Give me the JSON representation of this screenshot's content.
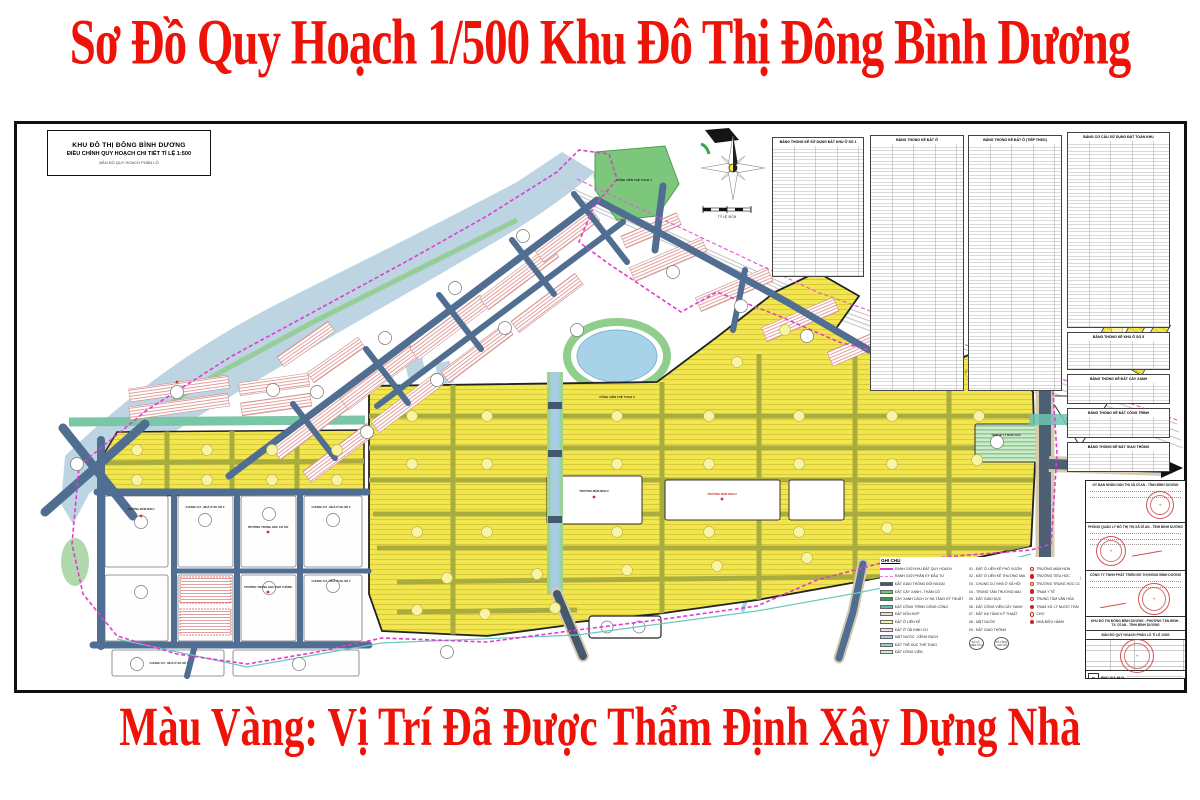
{
  "header": {
    "title": "Sơ Đồ Quy Hoạch 1/500 Khu Đô Thị Đông Bình Dương"
  },
  "footer": {
    "note": "Màu Vàng: Vị Trí Đã Được Thẩm Định Xây Dựng Nhà"
  },
  "title_block": {
    "line1": "KHU ĐÔ THỊ ĐÔNG BÌNH DƯƠNG",
    "line2": "ĐIỀU CHỈNH QUY HOẠCH CHI TIẾT TỈ LỆ 1:500",
    "line3": "BẢN ĐỒ QUY HOẠCH PHÂN LÔ"
  },
  "compass": {
    "scale_label": "TỶ LỆ XÍCH"
  },
  "stat_tables": [
    {
      "title": "BẢNG THỐNG KÊ SỬ DỤNG ĐẤT KHU Ở SỐ 1"
    },
    {
      "title": "BẢNG THỐNG KÊ ĐẤT Ở"
    },
    {
      "title": "BẢNG THỐNG KÊ ĐẤT Ở (TIẾP THEO)"
    },
    {
      "title": "BẢNG CƠ CẤU SỬ DỤNG ĐẤT TOÀN KHU"
    },
    {
      "title": "BẢNG THỐNG KÊ KHU Ở SỐ 5"
    },
    {
      "title": "BẢNG THỐNG KÊ ĐẤT CÂY XANH"
    },
    {
      "title": "BẢNG THỐNG KÊ ĐẤT CÔNG TRÌNH"
    },
    {
      "title": "BẢNG THỐNG KÊ ĐẤT GIAO THÔNG"
    }
  ],
  "map_labels": {
    "park1": "CÔNG VIÊN THỂ THAO 1",
    "park2": "CÔNG VIÊN THỂ THAO 2",
    "mn1": "TRƯỜNG MẦM NON 1",
    "mn2": "TRƯỜNG MẦM NON 2",
    "mn3": "TRƯỜNG MẦM NON 3",
    "mn4": "TRƯỜNG MẦM NON 4",
    "wwtp": "TRẠM XỬ LÝ NƯỚC THẢI",
    "apt1": "CHUNG CƯ - NHÀ Ở XH SỐ 1",
    "apt2": "CHUNG CƯ - NHÀ Ở XH SỐ 2",
    "apt3": "CHUNG CƯ - NHÀ Ở XH SỐ 3",
    "apt4": "CHUNG CƯ - NHÀ Ở XH SỐ 4",
    "thcs": "TRƯỜNG TRUNG HỌC CƠ SỞ",
    "thpt": "TRƯỜNG TRUNG HỌC PHỔ THÔNG"
  },
  "legend": {
    "title": "GHI CHÚ",
    "items": [
      {
        "swatch": "line-magenta",
        "label": "RANH GIỚI KHU ĐẤT QUY HOẠCH"
      },
      {
        "swatch": "line-pink-dash",
        "label": "RANH GIỚI PHÂN KỲ ĐẦU TƯ"
      },
      {
        "swatch": "#3c5a78",
        "label": "ĐẤT GIAO THÔNG ĐỐI NGOẠI"
      },
      {
        "swatch": "#6cc96c",
        "label": "ĐẤT CÂY XANH - THẢM CỎ"
      },
      {
        "swatch": "#2f9e44",
        "label": "CÂY XANH CÁCH LY HẠ TẦNG KỸ THUẬT"
      },
      {
        "swatch": "#5fbfae",
        "label": "ĐẤT CÔNG TRÌNH CÔNG CỘNG"
      },
      {
        "swatch": "#e8ddc6",
        "label": "ĐẤT HỖN HỢP"
      },
      {
        "swatch": "#f4eeb0",
        "label": "ĐẤT Ở LIÊN KẾ"
      },
      {
        "swatch": "#f3dcdc",
        "label": "ĐẤT Ở TÁI ĐỊNH CƯ"
      },
      {
        "swatch": "#aacfe4",
        "label": "MẶT NƯỚC - KÊNH RẠCH"
      },
      {
        "swatch": "#8fd4c8",
        "label": "ĐẤT THỂ DỤC THỂ THAO"
      },
      {
        "swatch": "#cdeccd",
        "label": "ĐẤT CÔNG VIÊN"
      }
    ],
    "notes": [
      "01 - ĐẤT Ở LIÊN KẾ PHỐ VƯỜN",
      "02 - ĐẤT Ở LIÊN KẾ THƯƠNG MẠI",
      "03 - CHUNG CƯ NHÀ Ở XÃ HỘI",
      "04 - TRUNG TÂM THƯƠNG MẠI",
      "05 - ĐẤT GIÁO DỤC",
      "06 - ĐẤT CÔNG VIÊN CÂY XANH",
      "07 - ĐẤT HẠ TẦNG KỸ THUẬT",
      "08 - MẶT NƯỚC",
      "09 - ĐẤT GIAO THÔNG"
    ],
    "note_symbols": [
      {
        "label": "SỐ LÔ - DIỆN TÍCH"
      },
      {
        "label": "SỐ TẦNG - MẬT ĐỘ"
      }
    ],
    "symbols": [
      {
        "label": "TRƯỜNG MẦM NON"
      },
      {
        "label": "TRƯỜNG TIỂU HỌC"
      },
      {
        "label": "TRƯỜNG TRUNG HỌC CƠ SỞ"
      },
      {
        "label": "TRẠM Y TẾ"
      },
      {
        "label": "TRUNG TÂM VĂN HÓA"
      },
      {
        "label": "TRẠM XỬ LÝ NƯỚC THẢI"
      },
      {
        "label": "CHỢ"
      },
      {
        "label": "NHÀ ĐIỀU HÀNH"
      }
    ]
  },
  "approval": {
    "sections": [
      "ỦY BAN NHÂN DÂN THỊ XÃ DĨ AN - TỈNH BÌNH DƯƠNG",
      "PHÒNG QUẢN LÝ ĐÔ THỊ THỊ XÃ DĨ AN - TỈNH BÌNH DƯƠNG",
      "CÔNG TY TNHH PHÁT TRIỂN ĐÔ THỊ ĐÔNG BÌNH DƯƠNG",
      "KHU ĐÔ THỊ ĐÔNG BÌNH DƯƠNG - PHƯỜNG TÂN BÌNH - TX. DĨ AN - TỈNH BÌNH DƯƠNG"
    ],
    "drawing_title": "BẢN ĐỒ QUY HOẠCH PHÂN LÔ TỈ LỆ 1/500",
    "company": "PHÚ GIA HUY",
    "logo_text": "P"
  },
  "palette": {
    "title_red": "#ee1208",
    "lot_yellow": "#f1e64e",
    "divider_olive": "#a9ad3f",
    "road_slate": "#4f6e92",
    "water_blue": "#bdd5e3",
    "park_green": "#7cc77c",
    "boundary_magenta": "#e03ccf",
    "stamp_red": "#c03030"
  }
}
